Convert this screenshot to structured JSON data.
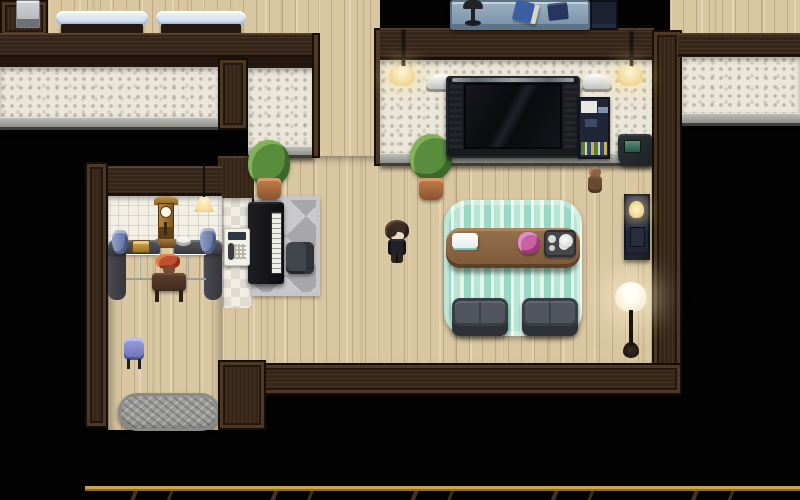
{
  "meta": {
    "type": "rpg-game-screenshot",
    "description": "Top-down RPG Maker style interior of a house: living room with wall TV and sofas, piano nook, kitchen/clock nook with wall phone, upper bedroom with blue benches, lower hallway with doormat, unexplored black areas and a marble corridor edge at the bottom",
    "visible_ui_text": []
  },
  "palette": {
    "background": "#000000",
    "wood_floor": "#d9c7a2",
    "wall_brown": "#36261a",
    "wallpaper_mosaic": "#ebe6da",
    "tile_white": "#f1eee6",
    "ledge_gray": "#8e8e8a",
    "rug_mint": "#cdeede",
    "rug_gray": "#b5b5b9",
    "sofa_gray": "#3a3f46",
    "table_brown": "#8a6544",
    "bench_blue": "#d6e4f2",
    "desk_blue": "#8aa0b4",
    "lamp_glow": "#ffe9ae",
    "marble_floor": "#efe8d6",
    "marble_trim_gold": "#caa44f",
    "accent_pink": "#c9609f",
    "stool_blue": "#8a91cc"
  },
  "rooms": [
    "upper bedroom (partially visible, two blue benches)",
    "sealed left room (only back wall visible, interior dark)",
    "living room with TV, mint rug, sofas and coffee table",
    "kitchen / clock nook with curved counters and wall phone",
    "piano nook with gray diamond rug",
    "lower hallway with blue stool and shaggy doormat",
    "right room (interior dark)",
    "bottom marble corridor (edge visible with gold trim)"
  ],
  "player": {
    "label": "Player character",
    "appearance": "short dark-haired figure in black outfit",
    "facing": "down",
    "position": "center of living room floor"
  },
  "objects": {
    "appliance": {
      "label": "Gray appliance"
    },
    "bench_left": {
      "label": "Light blue bench"
    },
    "bench_right": {
      "label": "Light blue bench"
    },
    "landscape_painting": {
      "label": "Framed landscape painting"
    },
    "corner_plant": {
      "label": "Potted plant"
    },
    "tv_plant": {
      "label": "Potted plant"
    },
    "wall_lamp_left": {
      "label": "Hanging wall lamp"
    },
    "wall_lamp_right": {
      "label": "Hanging wall lamp"
    },
    "study_desk": {
      "label": "Blue study desk"
    },
    "desk_lamp": {
      "label": "Desk lamp"
    },
    "blue_book": {
      "label": "Blue book"
    },
    "navy_book": {
      "label": "Navy book"
    },
    "dark_shelf": {
      "label": "Dark cabinet"
    },
    "tv": {
      "label": "Widescreen wall TV"
    },
    "sconce_left": {
      "label": "Wall sconce"
    },
    "sconce_right": {
      "label": "Wall sconce"
    },
    "panorama_photo": {
      "label": "Panoramic picture"
    },
    "bookshelf": {
      "label": "Bookshelf with books"
    },
    "framed_photo": {
      "label": "Framed photo"
    },
    "corner_desk": {
      "label": "Corner desk with monitor"
    },
    "plush_doll": {
      "label": "Plush doll"
    },
    "side_cabinet": {
      "label": "Side cabinet with reading lamp"
    },
    "floor_lamp": {
      "label": "Floor lamp"
    },
    "mint_rug": {
      "label": "Mint striped area rug"
    },
    "coffee_table": {
      "label": "Wooden coffee table"
    },
    "cake_plate": {
      "label": "Cake on a plate"
    },
    "pink_flowers": {
      "label": "Pink flower arrangement"
    },
    "tea_tray": {
      "label": "Tea tray with pot and cups"
    },
    "sofa_left": {
      "label": "Gray sofa"
    },
    "sofa_right": {
      "label": "Gray sofa"
    },
    "piano_rug": {
      "label": "Gray diamond rug"
    },
    "piano": {
      "label": "Upright piano"
    },
    "piano_chair": {
      "label": "Piano chair"
    },
    "wall_window": {
      "label": "Framed window picture"
    },
    "grandfather_clock": {
      "label": "Grandfather clock"
    },
    "pendant_lamp": {
      "label": "Pendant lamp"
    },
    "counter_left": {
      "label": "Curved counter"
    },
    "counter_right": {
      "label": "Curved counter"
    },
    "vase_left": {
      "label": "Blue vase"
    },
    "gold_box": {
      "label": "Golden box"
    },
    "white_bowl": {
      "label": "White bowl"
    },
    "vase_right": {
      "label": "Blue vase"
    },
    "flower_table": {
      "label": "Side table with red flowers"
    },
    "wall_phone": {
      "label": "Wall phone"
    },
    "blue_stool": {
      "label": "Blue stool"
    },
    "doormat": {
      "label": "Gray shaggy doormat"
    },
    "marble_floor": {
      "label": "Marble corridor floor with gold trim"
    }
  }
}
